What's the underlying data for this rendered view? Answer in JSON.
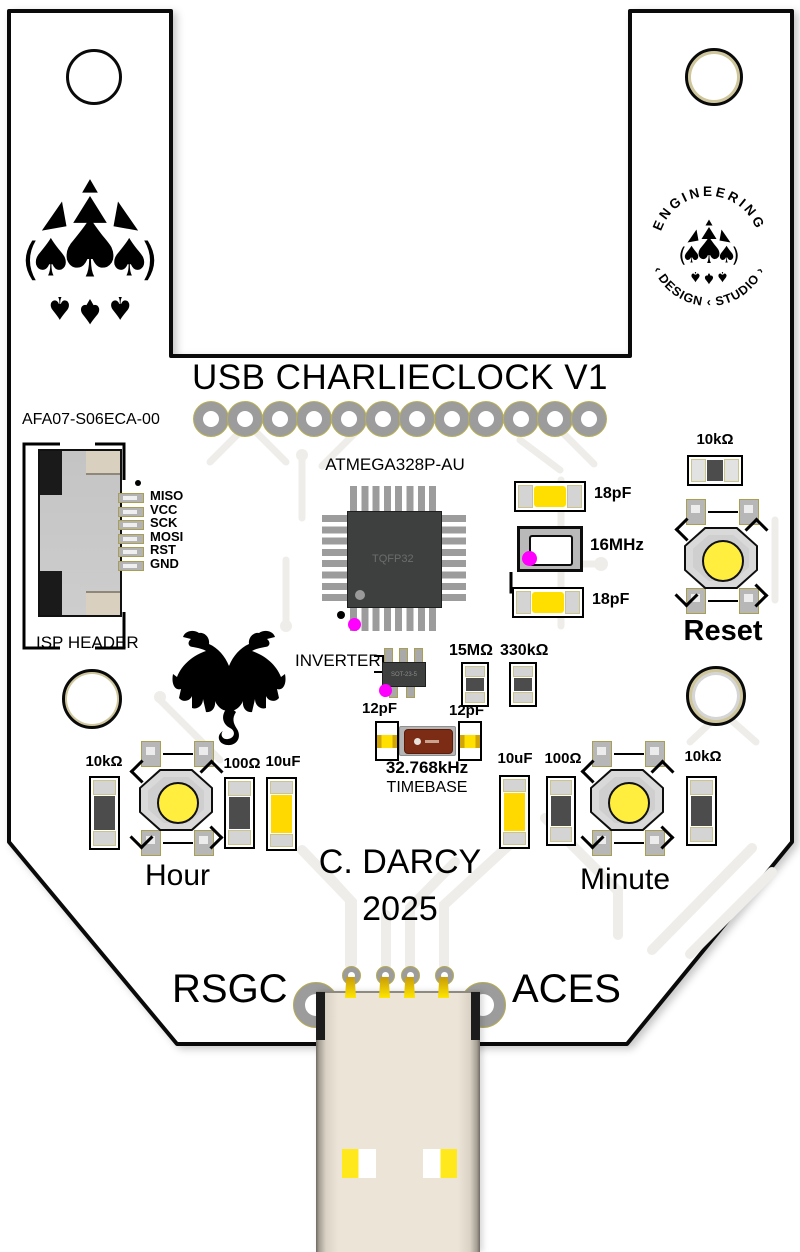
{
  "board": {
    "title": "USB CHARLIECLOCK V1",
    "author": "C. DARCY",
    "year": "2025",
    "footer_left": "RSGC",
    "footer_right": "ACES"
  },
  "logos": {
    "ring_top": "ENGINEERING",
    "ring_bottom": "‹  DESIGN  ‹  STUDIO  ›",
    "spade_glyph": "♠"
  },
  "isp": {
    "part": "AFA07-S06ECA-00",
    "caption": "ISP HEADER",
    "pins": [
      "MISO",
      "VCC",
      "SCK",
      "MOSI",
      "RST",
      "GND"
    ]
  },
  "mcu": {
    "part": "ATMEGA328P-AU",
    "package": "TQFP32"
  },
  "clock16": {
    "cap_top": "18pF",
    "crystal": "16MHz",
    "cap_bottom": "18pF"
  },
  "reset": {
    "resistor": "10kΩ",
    "label": "Reset"
  },
  "inverter": {
    "label": "INVERTER",
    "package": "SOT-23-5"
  },
  "bias": {
    "r1": "15MΩ",
    "r2": "330kΩ"
  },
  "timebase": {
    "cap_left": "12pF",
    "cap_right": "12pF",
    "freq": "32.768kHz",
    "caption": "TIMEBASE"
  },
  "hour": {
    "pullup": "10kΩ",
    "series": "100Ω",
    "cap": "10uF",
    "label": "Hour"
  },
  "minute": {
    "cap": "10uF",
    "series": "100Ω",
    "pullup": "10kΩ",
    "label": "Minute"
  },
  "colors": {
    "silk": "#000000",
    "component_yellow": "#ffdf00",
    "marker_magenta": "#ff00ff",
    "crystal_body": "#7c2b15",
    "connector_beige": "#ebe4d7",
    "pad_gray": "#9c9c9c",
    "chip_body": "#3e4040",
    "button_cap_yellow": "#ffee3e"
  }
}
